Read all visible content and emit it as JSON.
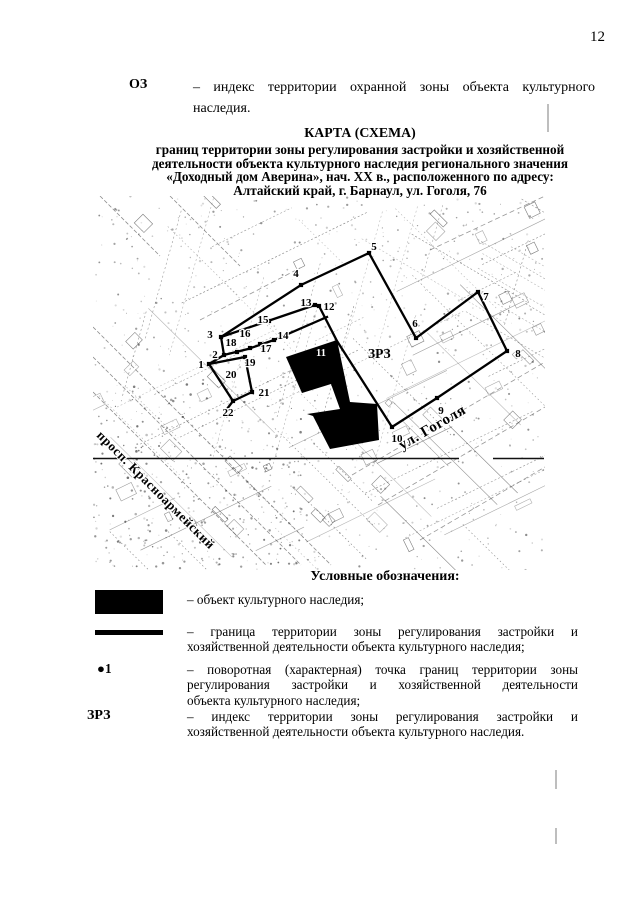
{
  "page": {
    "number": "12"
  },
  "definition": {
    "term": "ОЗ",
    "lines": [
      "– индекс территории охранной зоны объекта культурного",
      "наследия."
    ]
  },
  "title": {
    "lines": [
      "КАРТА (СХЕМА)",
      "границ территории зоны регулирования застройки и хозяйственной",
      "деятельности объекта культурного наследия регионального значения",
      "«Доходный дом Аверина», нач. XX в., расположенного по адресу:",
      "Алтайский край, г. Барнаул, ул. Гоголя, 76"
    ]
  },
  "map": {
    "zone_label": {
      "text": "ЗРЗ",
      "x": 368,
      "y": 358
    },
    "building": {
      "points": "286,357 337,340 350,402 377,404 379,440 330,449 313,416 307,414 340,409 331,384 302,393",
      "label": {
        "text": "11",
        "x": 321,
        "y": 356
      }
    },
    "boundary_polylines": [
      [
        [
          221,
          337
        ],
        [
          301,
          285
        ],
        [
          369,
          253
        ],
        [
          416,
          338
        ],
        [
          478,
          292
        ],
        [
          507,
          351
        ],
        [
          437,
          398
        ],
        [
          392,
          427
        ],
        [
          337,
          341
        ],
        [
          319,
          306
        ],
        [
          315,
          305
        ],
        [
          221,
          337
        ]
      ],
      [
        [
          327,
          317
        ],
        [
          274,
          340
        ],
        [
          248,
          349
        ],
        [
          224,
          355
        ]
      ],
      [
        [
          221,
          337
        ],
        [
          224,
          355
        ],
        [
          209,
          364
        ]
      ],
      [
        [
          209,
          364
        ],
        [
          245,
          357
        ],
        [
          252,
          392
        ],
        [
          233,
          401
        ],
        [
          209,
          364
        ]
      ],
      [
        [
          233,
          401
        ],
        [
          227,
          409
        ]
      ]
    ],
    "rule_lines": [
      [
        93,
        458.5,
        459,
        458.5
      ],
      [
        493,
        458.5,
        544,
        458.5
      ]
    ],
    "vertices": [
      {
        "n": "1",
        "mx": 209,
        "my": 364,
        "lx": 201,
        "ly": 368
      },
      {
        "n": "2",
        "mx": 224,
        "my": 355,
        "lx": 215,
        "ly": 358
      },
      {
        "n": "3",
        "mx": 221,
        "my": 337,
        "lx": 210,
        "ly": 338
      },
      {
        "n": "4",
        "mx": 301,
        "my": 285,
        "lx": 296,
        "ly": 277
      },
      {
        "n": "5",
        "mx": 369,
        "my": 253,
        "lx": 374,
        "ly": 250
      },
      {
        "n": "6",
        "mx": 416,
        "my": 338,
        "lx": 415,
        "ly": 327
      },
      {
        "n": "7",
        "mx": 478,
        "my": 292,
        "lx": 486,
        "ly": 300
      },
      {
        "n": "8",
        "mx": 507,
        "my": 351,
        "lx": 518,
        "ly": 357
      },
      {
        "n": "9",
        "mx": 437,
        "my": 398,
        "lx": 441,
        "ly": 414
      },
      {
        "n": "10",
        "mx": 392,
        "my": 427,
        "lx": 397,
        "ly": 442
      },
      {
        "n": "12",
        "mx": 319,
        "my": 306,
        "lx": 329,
        "ly": 310
      },
      {
        "n": "13",
        "mx": 315,
        "my": 305,
        "lx": 306,
        "ly": 306
      },
      {
        "n": "14",
        "mx": 274,
        "my": 340,
        "lx": 283,
        "ly": 339
      },
      {
        "n": "15",
        "mx": 269,
        "my": 321,
        "lx": 263,
        "ly": 323
      },
      {
        "n": "16",
        "mx": 250,
        "my": 348,
        "lx": 245,
        "ly": 337
      },
      {
        "n": "17",
        "mx": 260,
        "my": 344,
        "lx": 266,
        "ly": 352
      },
      {
        "n": "18",
        "mx": 237,
        "my": 352,
        "lx": 231,
        "ly": 346
      },
      {
        "n": "19",
        "mx": 245,
        "my": 357,
        "lx": 250,
        "ly": 366
      },
      {
        "n": "20",
        "mx": null,
        "my": null,
        "lx": 231,
        "ly": 378
      },
      {
        "n": "21",
        "mx": 252,
        "my": 392,
        "lx": 264,
        "ly": 396
      },
      {
        "n": "22",
        "mx": 233,
        "my": 401,
        "lx": 228,
        "ly": 416
      }
    ],
    "streets": [
      {
        "name": "ул. Гоголя",
        "x": 402,
        "y": 450,
        "angle": -30,
        "size": 15
      },
      {
        "name": "просп. Красноармейский",
        "x": 96,
        "y": 436,
        "angle": 45,
        "size": 13
      }
    ],
    "scan_marks": [
      [
        548,
        104,
        548,
        132
      ],
      [
        556,
        770,
        556,
        789
      ],
      [
        556,
        828,
        556,
        844
      ]
    ]
  },
  "legend": {
    "heading": "Условные обозначения:",
    "items": [
      {
        "symbol": "rect",
        "symbol_text": "",
        "lines": [
          "– объект культурного наследия;"
        ]
      },
      {
        "symbol": "line",
        "symbol_text": "",
        "lines": [
          "– граница территории зоны регулирования застройки и",
          "хозяйственной деятельности объекта культурного наследия;"
        ]
      },
      {
        "symbol": "point",
        "symbol_text": "●1",
        "lines": [
          "– поворотная (характерная) точка границ территории зоны",
          "регулирования застройки и хозяйственной деятельности",
          "объекта культурного наследия;"
        ]
      },
      {
        "symbol": "text",
        "symbol_text": "ЗРЗ",
        "lines": [
          "– индекс территории зоны регулирования застройки и",
          "хозяйственной деятельности объекта культурного наследия."
        ]
      }
    ]
  }
}
